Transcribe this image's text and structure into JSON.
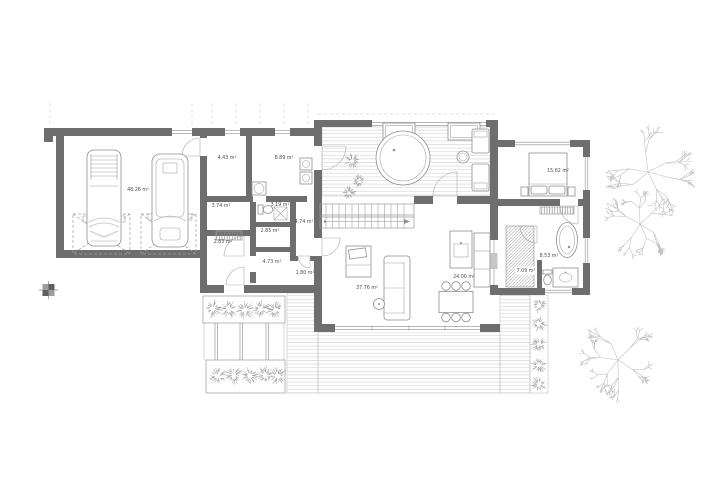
{
  "colors": {
    "wall": "#6e6e6e",
    "line": "#9b9b9b",
    "deck_line": "#d6d6d6",
    "vegetation": "#c2c2c2",
    "label": "#4d4d4d"
  },
  "areas": {
    "garage": "48.26 m²",
    "mudroom": "4.43 m²",
    "utility_room": "8.89 m²",
    "hall": "3.74 m²",
    "toilet_room": "3.19 m²",
    "pantry": "2.85 m²",
    "storage": "2.83 m²",
    "corridor": "4.74 m²",
    "hallway": "4.73 m²",
    "wc": "1.80 m²",
    "living_room": "37.76 m²",
    "kitchen_dining": "24.00 m²",
    "bedroom": "15.62 m²",
    "bathroom": "8.53 m²",
    "wardrobe": "7.09 m²"
  }
}
